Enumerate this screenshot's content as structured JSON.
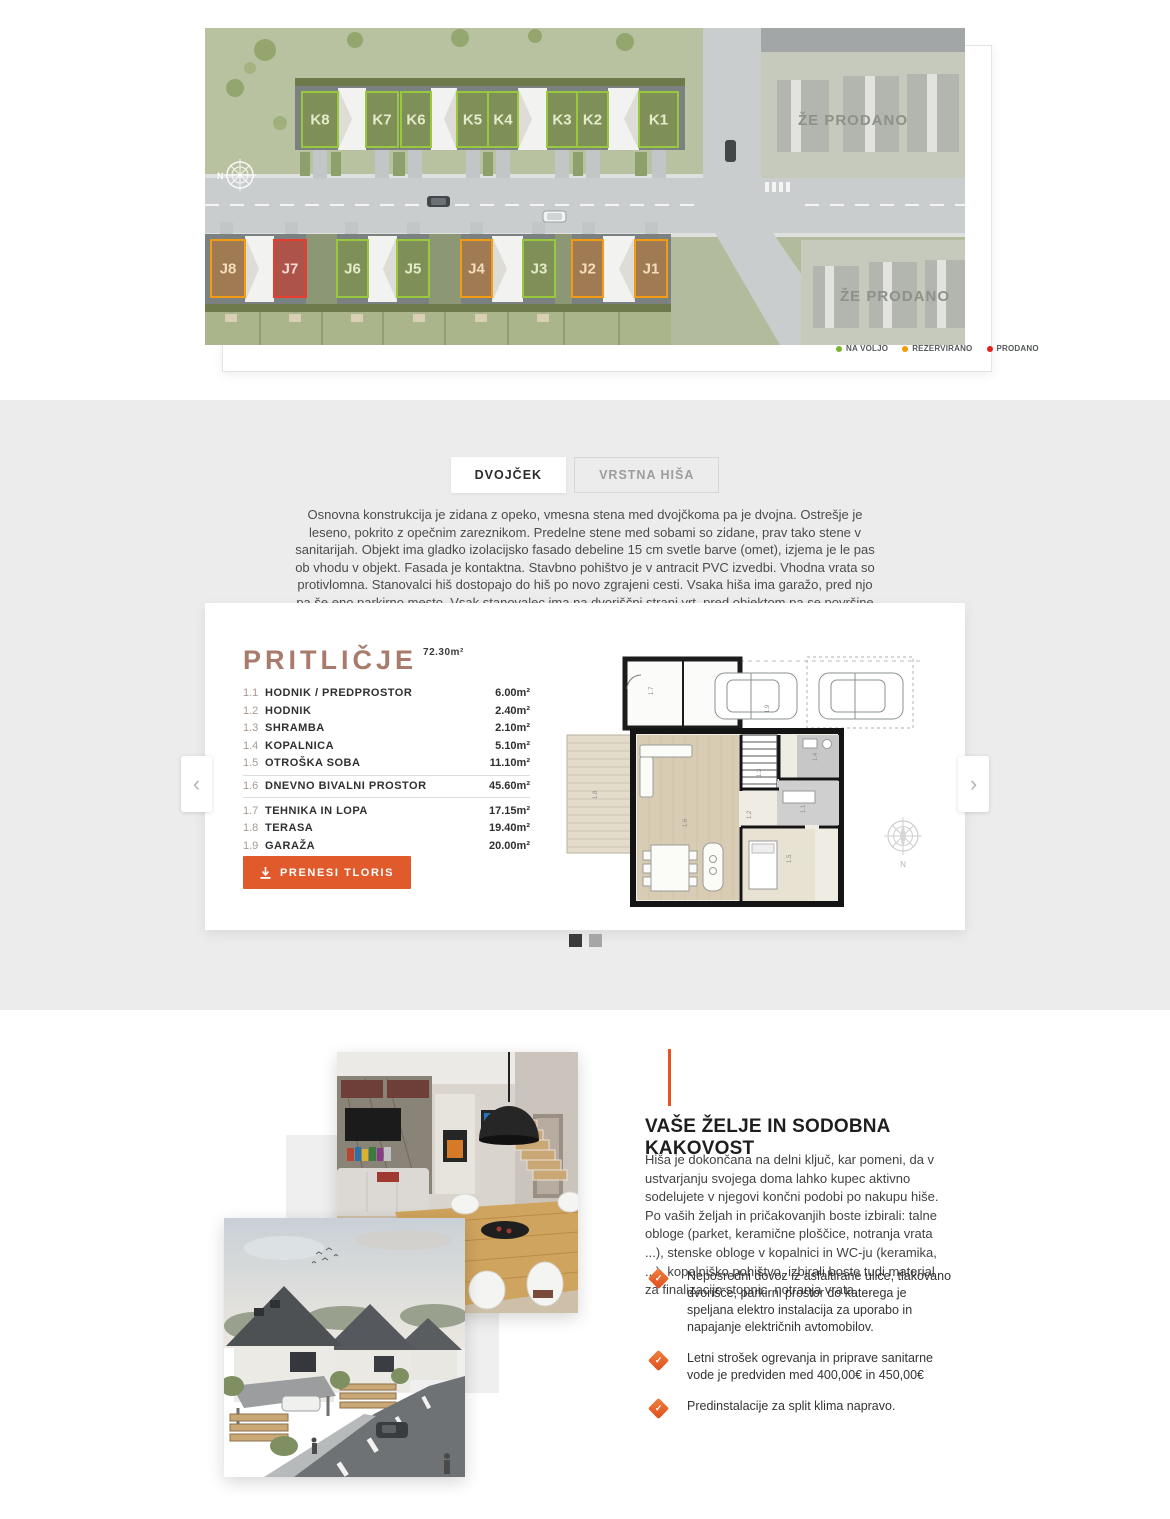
{
  "siteplan": {
    "north_label": "N",
    "sold_area_label": "ŽE PRODANO",
    "legend": [
      {
        "label": "NA VOLJO",
        "color": "#76b82a"
      },
      {
        "label": "REZERVIRANO",
        "color": "#f59c00"
      },
      {
        "label": "PRODANO",
        "color": "#e5231b"
      }
    ],
    "status_colors": {
      "na voljo": {
        "fill": "#7e9154",
        "stroke": "#97c83e",
        "text": "#e3ecca"
      },
      "rezervirano": {
        "fill": "#a3794e",
        "stroke": "#f39c12",
        "text": "#f3ddba"
      },
      "prodano": {
        "fill": "#b14f44",
        "stroke": "#e73c2e",
        "text": "#f6d9d2"
      }
    },
    "houses_row_top": [
      {
        "id": "K8",
        "status": "na voljo"
      },
      {
        "id": "K7",
        "status": "na voljo"
      },
      {
        "id": "K6",
        "status": "na voljo"
      },
      {
        "id": "K5",
        "status": "na voljo"
      },
      {
        "id": "K4",
        "status": "na voljo"
      },
      {
        "id": "K3",
        "status": "na voljo"
      },
      {
        "id": "K2",
        "status": "na voljo"
      },
      {
        "id": "K1",
        "status": "na voljo"
      }
    ],
    "houses_row_bottom": [
      {
        "id": "J8",
        "status": "rezervirano"
      },
      {
        "id": "J7",
        "status": "prodano"
      },
      {
        "id": "J6",
        "status": "na voljo"
      },
      {
        "id": "J5",
        "status": "na voljo"
      },
      {
        "id": "J4",
        "status": "rezervirano"
      },
      {
        "id": "J3",
        "status": "na voljo"
      },
      {
        "id": "J2",
        "status": "rezervirano"
      },
      {
        "id": "J1",
        "status": "rezervirano"
      }
    ]
  },
  "tabs": [
    {
      "label": "DVOJČEK",
      "active": true
    },
    {
      "label": "VRSTNA HIŠA",
      "active": false
    }
  ],
  "intro": "Osnovna konstrukcija je zidana z opeko, vmesna stena med dvojčkoma pa je dvojna. Ostrešje je leseno, pokrito z opečnim zareznikom. Predelne stene med sobami so zidane, prav tako stene v sanitarijah. Objekt ima gladko izolacijsko fasado debeline 15 cm svetle barve (omet), izjema je le pas ob vhodu v objekt. Fasada je kontaktna. Stavbno pohištvo je v antracit PVC izvedbi. Vhodna vrata so protivlomna. Stanovalci hiš dostopajo do hiš po novo zgrajeni cesti. Vsaka hiša ima garažo, pred njo pa še eno parkirno mesto. Vsak stanovalec ima na dvoriščni strani vrt, pred objektom pa se površine tlakujejo in kombinirajo z manjšo zelenico.",
  "floorplan": {
    "title": "PRITLIČJE",
    "total_area": "72.30m²",
    "rooms": [
      {
        "num": "1.1",
        "name": "HODNIK / PREDPROSTOR",
        "area": "6.00m²"
      },
      {
        "num": "1.2",
        "name": "HODNIK",
        "area": "2.40m²"
      },
      {
        "num": "1.3",
        "name": "SHRAMBA",
        "area": "2.10m²"
      },
      {
        "num": "1.4",
        "name": "KOPALNICA",
        "area": "5.10m²"
      },
      {
        "num": "1.5",
        "name": "OTROŠKA SOBA",
        "area": "11.10m²"
      },
      {
        "num": "1.6",
        "name": "DNEVNO BIVALNI PROSTOR",
        "area": "45.60m²"
      },
      {
        "num": "1.7",
        "name": "TEHNIKA IN LOPA",
        "area": "17.15m²"
      },
      {
        "num": "1.8",
        "name": "TERASA",
        "area": "19.40m²"
      },
      {
        "num": "1.9",
        "name": "GARAŽA",
        "area": "20.00m²"
      }
    ],
    "download_label": "PRENESI TLORIS",
    "compass_label": "N"
  },
  "carousel": {
    "dot_count": 2,
    "active_index": 0
  },
  "features": {
    "heading": "VAŠE ŽELJE IN SODOBNA KAKOVOST",
    "body": "Hiša je dokončana na delni ključ, kar pomeni, da v ustvarjanju svojega doma lahko kupec aktivno sodelujete v njegovi končni podobi po nakupu hiše. Po vaših željah in pričakovanjih boste izbirali: talne obloge (parket, keramične ploščice, notranja vrata ...), stenske obloge v kopalnici in WC-ju (keramika, ...), kopalniško pohištvo, izbirali boste tudi material za finalizacijo stopnic, notranja vrata, ...",
    "bullets": [
      "Neposredni dovoz iz asfaltirane ulice, tlakovano dvorišče, parkirni prostor do katerega je speljana elektro instalacija za uporabo in napajanje električnih avtomobilov.",
      "Letni strošek ogrevanja in priprave sanitarne vode je predviden med 400,00€ in 450,00€",
      "Predinstalacije za split klima napravo."
    ]
  },
  "icons": {
    "prev_arrow": "‹",
    "next_arrow": "›",
    "bullet_check": "✓"
  },
  "colors": {
    "accent_orange": "#e05a2b",
    "title_brown": "#a87b6c",
    "band_gray": "#ececec"
  }
}
